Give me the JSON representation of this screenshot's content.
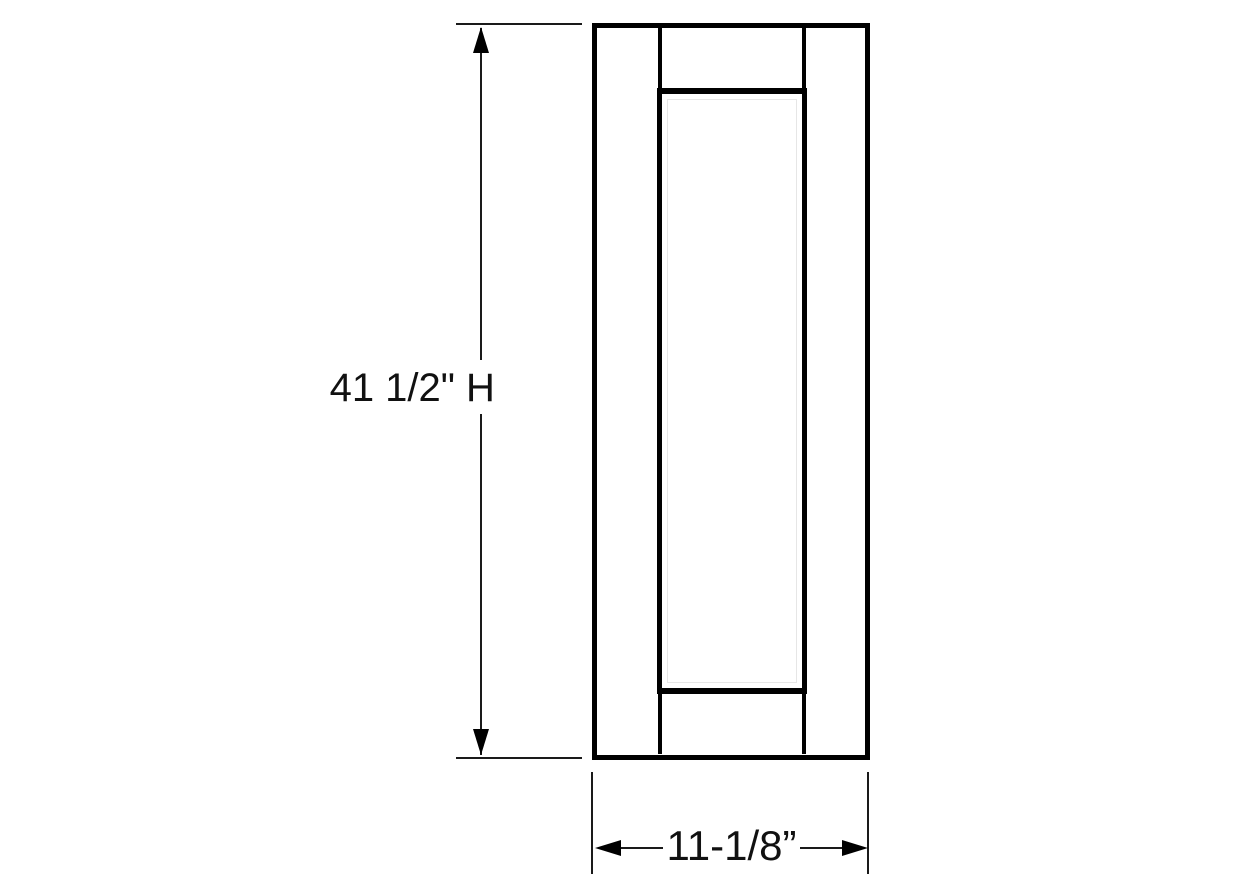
{
  "drawing": {
    "type": "cabinet-door-elevation",
    "height_dimension": {
      "value": "41 1/2\"",
      "suffix": "H"
    },
    "width_dimension": {
      "value": "11-1/8”"
    },
    "colors": {
      "line": "#000000",
      "text": "#111111",
      "background": "#ffffff"
    }
  }
}
